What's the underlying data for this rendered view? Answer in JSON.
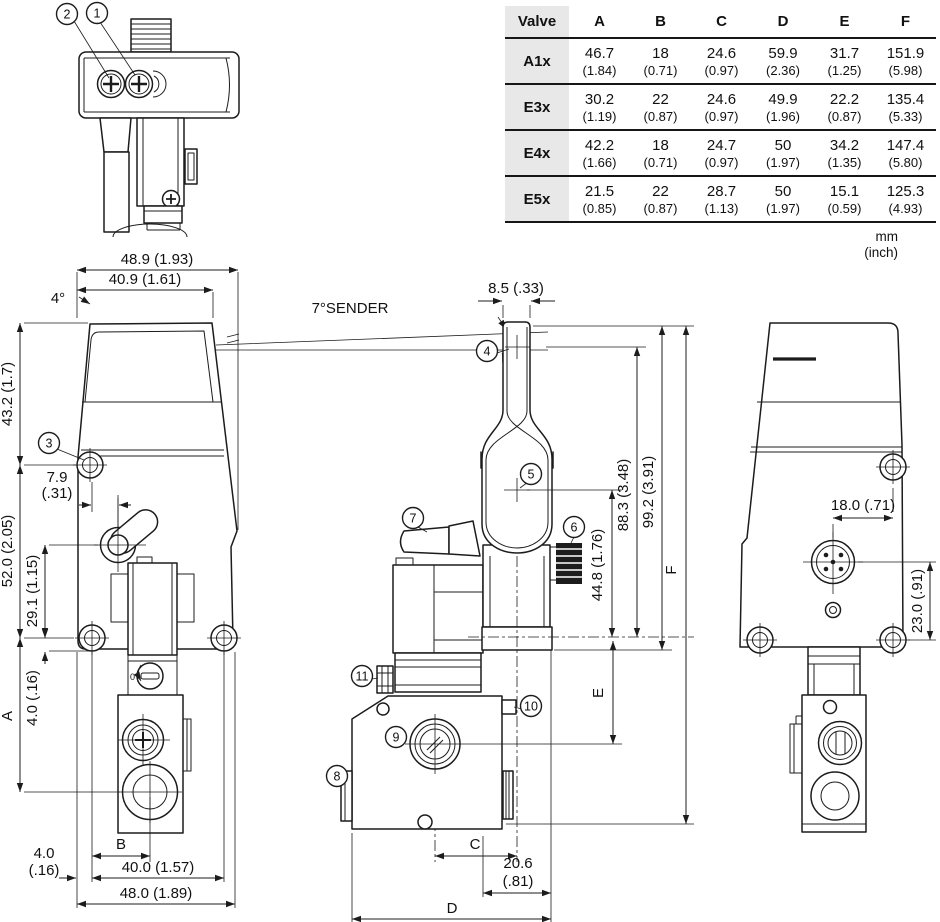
{
  "table": {
    "col_headers": [
      "Valve",
      "A",
      "B",
      "C",
      "D",
      "E",
      "F"
    ],
    "rows": [
      {
        "valve": "A1x",
        "mm": [
          "46.7",
          "18",
          "24.6",
          "59.9",
          "31.7",
          "151.9"
        ],
        "inch": [
          "(1.84)",
          "(0.71)",
          "(0.97)",
          "(2.36)",
          "(1.25)",
          "(5.98)"
        ]
      },
      {
        "valve": "E3x",
        "mm": [
          "30.2",
          "22",
          "24.6",
          "49.9",
          "22.2",
          "135.4"
        ],
        "inch": [
          "(1.19)",
          "(0.87)",
          "(0.97)",
          "(1.96)",
          "(0.87)",
          "(5.33)"
        ]
      },
      {
        "valve": "E4x",
        "mm": [
          "42.2",
          "18",
          "24.7",
          "50",
          "34.2",
          "147.4"
        ],
        "inch": [
          "(1.66)",
          "(0.71)",
          "(0.97)",
          "(1.97)",
          "(1.35)",
          "(5.80)"
        ]
      },
      {
        "valve": "E5x",
        "mm": [
          "21.5",
          "22",
          "28.7",
          "50",
          "15.1",
          "125.3"
        ],
        "inch": [
          "(0.85)",
          "(0.87)",
          "(1.13)",
          "(1.97)",
          "(0.59)",
          "(4.93)"
        ]
      }
    ],
    "unit_mm": "mm",
    "unit_inch": "(inch)"
  },
  "callouts": {
    "c1": "1",
    "c2": "2",
    "c3": "3",
    "c4": "4",
    "c5": "5",
    "c6": "6",
    "c7": "7",
    "c8": "8",
    "c9": "9",
    "c10": "10",
    "c11": "11"
  },
  "labels": {
    "sender": "7°SENDER",
    "zero": "0"
  },
  "dims": {
    "left": {
      "w489": "48.9 (1.93)",
      "w409": "40.9 (1.61)",
      "a4": "4°",
      "h432": "43.2 (1.7)",
      "d79": "7.9",
      "d79i": "(.31)",
      "h520": "52.0 (2.05)",
      "h291": "29.1 (1.15)",
      "A": "A",
      "h40": "4.0 (.16)",
      "b40": "4.0",
      "b40i": "(.16)",
      "B": "B",
      "w400": "40.0 (1.57)",
      "w480": "48.0 (1.89)"
    },
    "mid": {
      "w85": "8.5 (.33)",
      "v448": "44.8 (1.76)",
      "v883": "88.3 (3.48)",
      "v992": "99.2 (3.91)",
      "F": "F",
      "E": "E",
      "C": "C",
      "w206": "20.6",
      "w206i": "(.81)",
      "D": "D"
    },
    "right": {
      "w180": "18.0 (.71)",
      "v230": "23.0 (.91)"
    }
  }
}
